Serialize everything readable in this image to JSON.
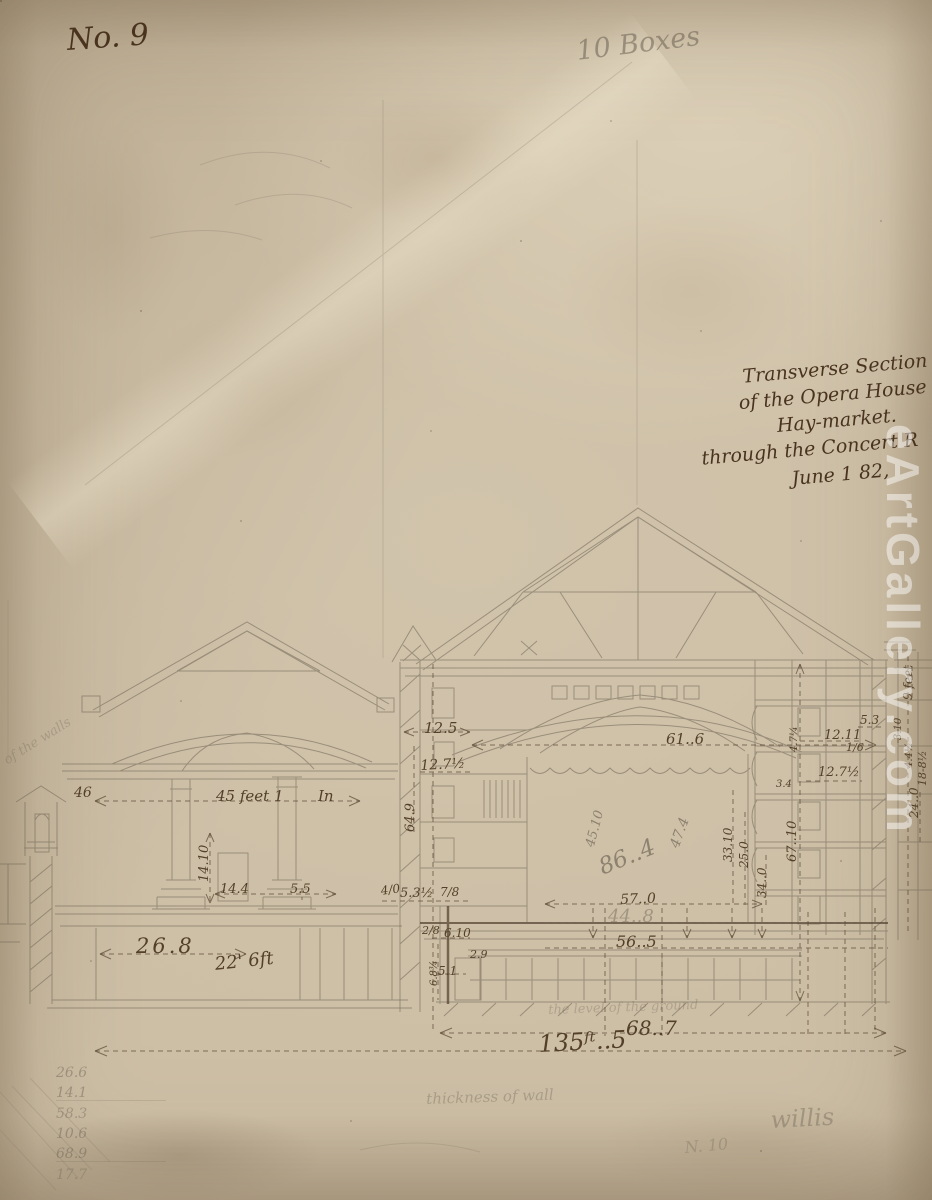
{
  "labels": {
    "sheet_no": "No. 9",
    "boxes_note": "10 Boxes",
    "watermark": "eArtGallery.com",
    "signature": "willis",
    "secondary_no": "N. 10",
    "thickness_note": "thickness of wall",
    "ground_note": "the level of the ground",
    "walls_note": "of the walls",
    "wall_ref": "46"
  },
  "title_block": {
    "line1": "Transverse Section",
    "line2": "of the Opera House",
    "line3": "Hay-market.",
    "line4": "through the Concert R",
    "line5": "June 1 82,"
  },
  "dimensions": {
    "d45a": "45 feet 1",
    "d45b": "In",
    "d14_10": "14.10",
    "d14_4": "14.4",
    "d5_5": "5.5",
    "d26_8": "26.8",
    "d22_6": "22' 6ft",
    "d12_5": "12.5",
    "d61_6": "61..6",
    "d12_7a": "12.7½",
    "d64_9": "64.9",
    "d45_10": "45.10",
    "d86_4": "86..4",
    "d47_4": "47.4",
    "d33_10": "33.10",
    "d25_0": "25.0",
    "d34_0": "34..0",
    "d57_0": "57..0",
    "d44_8": "44..8",
    "d56_5": "56..5",
    "d67_10": "67..10",
    "d24_0": "24..0",
    "d9ft": "9 feet",
    "d5_3": "5.3",
    "d12_11": "12.11",
    "d1_6": "1/6",
    "d3_10": "3.10",
    "d4_4": "4.4½",
    "d12_7b": "12.7½",
    "d18_8": "18-8½",
    "d3_4": "3.4",
    "d4_7": "4.7¼",
    "d68_7": "68..7",
    "d135_5": "135ᶠᵗ..5",
    "d6_10": "6.10",
    "d2_8": "2/8",
    "d5_1": "5.1",
    "d6_8": "6.8¾",
    "d2_9": "2.9",
    "d4_0": "4/0",
    "d5_3h": "5.3½",
    "d7_8": "7/8"
  },
  "calc_column": [
    "26.6",
    "14.1",
    "58.3",
    "10.6",
    "68.9",
    "17.7"
  ],
  "colors": {
    "paper": "#cdbfa6",
    "ink": "#4a3426",
    "pencil": "#6f6557",
    "watermark_text": "#ffffff"
  }
}
